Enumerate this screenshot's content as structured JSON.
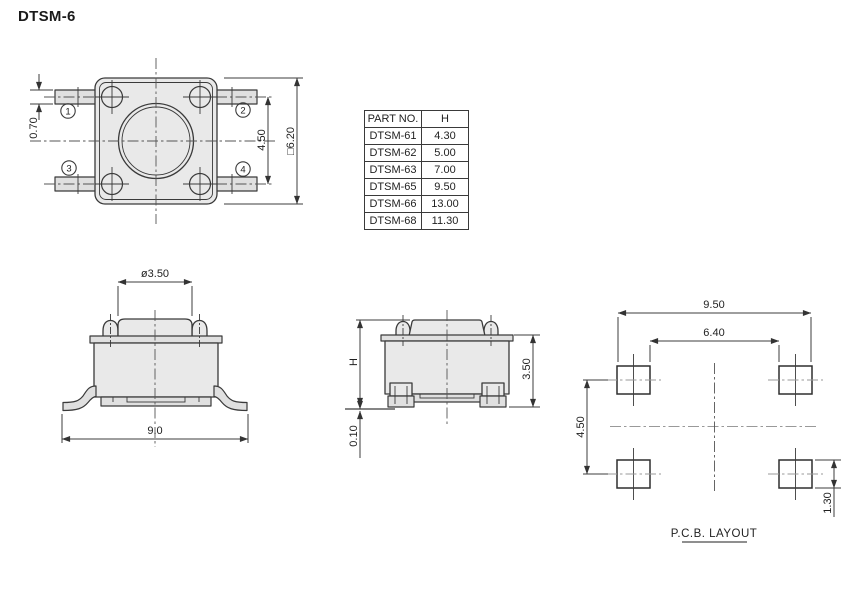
{
  "title": "DTSM-6",
  "top_view": {
    "pin1": "1",
    "pin2": "2",
    "pin3": "3",
    "pin4": "4",
    "dim_terminal_width": "0.70",
    "dim_pin_pitch": "4.50",
    "dim_body_square": "□6.20"
  },
  "parts_table": {
    "col_part": "PART NO.",
    "col_h": "H",
    "rows": [
      [
        "DTSM-61",
        "4.30"
      ],
      [
        "DTSM-62",
        "5.00"
      ],
      [
        "DTSM-63",
        "7.00"
      ],
      [
        "DTSM-65",
        "9.50"
      ],
      [
        "DTSM-66",
        "13.00"
      ],
      [
        "DTSM-68",
        "11.30"
      ]
    ]
  },
  "front_view": {
    "dim_button_dia": "ø3.50",
    "dim_overall_width": "9.0"
  },
  "side_view": {
    "dim_height": "H",
    "dim_body_height": "3.50",
    "dim_standoff": "0.10"
  },
  "pcb_layout": {
    "dim_span_outer": "9.50",
    "dim_span_inner": "6.40",
    "dim_row_pitch": "4.50",
    "dim_pad_height": "1.30",
    "label": "P.C.B. LAYOUT"
  },
  "colors": {
    "body_fill": "#e9e9e9",
    "line": "#3a3a3a",
    "background": "#ffffff"
  }
}
